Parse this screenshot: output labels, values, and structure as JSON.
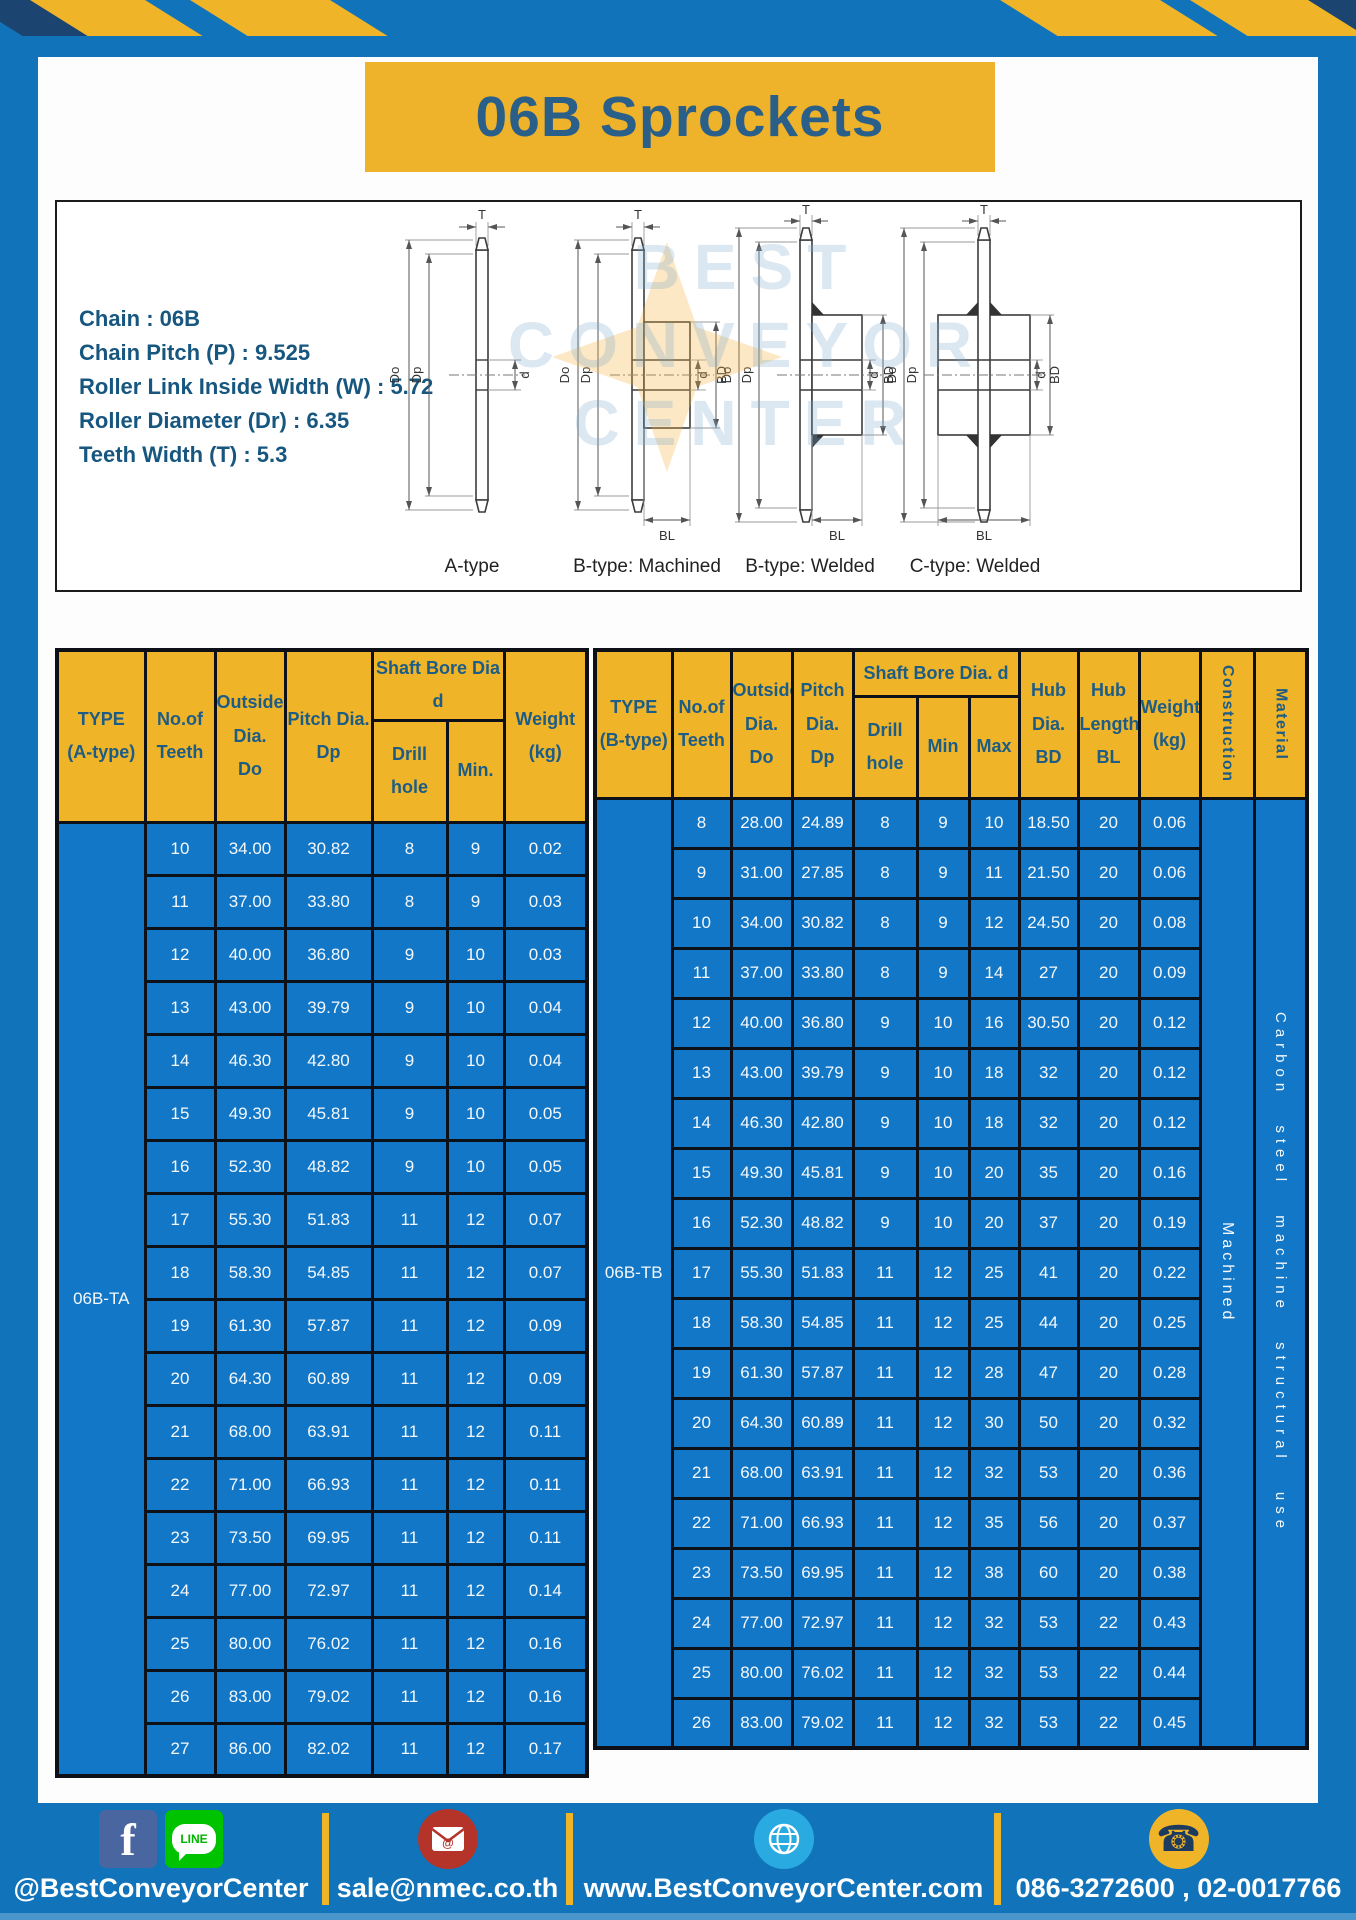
{
  "title": "06B Sprockets",
  "specs": {
    "lines": [
      "Chain : 06B",
      "Chain Pitch (P) : 9.525",
      "Roller Link Inside Width (W) : 5.72",
      "Roller Diameter (Dr) : 6.35",
      "Teeth Width (T) : 5.3"
    ]
  },
  "drawings": {
    "labels": {
      "T": "T",
      "Do": "Do",
      "Dp": "Dp",
      "d": "d",
      "BD": "BD",
      "BL": "BL"
    },
    "captions": [
      "A-type",
      "B-type: Machined",
      "B-type: Welded",
      "C-type: Welded"
    ]
  },
  "watermark": {
    "line1": "BEST",
    "line2": "CONVEYOR",
    "line3": "CENTER"
  },
  "table_a": {
    "headers": {
      "type": "TYPE\n(A-type)",
      "teeth": "No.of\nTeeth",
      "outside": "Outside\nDia.\nDo",
      "pitch": "Pitch Dia.\nDp",
      "shaft_group": "Shaft Bore Dia d",
      "drill": "Drill hole",
      "min": "Min.",
      "weight": "Weight\n(kg)"
    },
    "type_value": "06B-TA",
    "rows": [
      [
        "10",
        "34.00",
        "30.82",
        "8",
        "9",
        "0.02"
      ],
      [
        "11",
        "37.00",
        "33.80",
        "8",
        "9",
        "0.03"
      ],
      [
        "12",
        "40.00",
        "36.80",
        "9",
        "10",
        "0.03"
      ],
      [
        "13",
        "43.00",
        "39.79",
        "9",
        "10",
        "0.04"
      ],
      [
        "14",
        "46.30",
        "42.80",
        "9",
        "10",
        "0.04"
      ],
      [
        "15",
        "49.30",
        "45.81",
        "9",
        "10",
        "0.05"
      ],
      [
        "16",
        "52.30",
        "48.82",
        "9",
        "10",
        "0.05"
      ],
      [
        "17",
        "55.30",
        "51.83",
        "11",
        "12",
        "0.07"
      ],
      [
        "18",
        "58.30",
        "54.85",
        "11",
        "12",
        "0.07"
      ],
      [
        "19",
        "61.30",
        "57.87",
        "11",
        "12",
        "0.09"
      ],
      [
        "20",
        "64.30",
        "60.89",
        "11",
        "12",
        "0.09"
      ],
      [
        "21",
        "68.00",
        "63.91",
        "11",
        "12",
        "0.11"
      ],
      [
        "22",
        "71.00",
        "66.93",
        "11",
        "12",
        "0.11"
      ],
      [
        "23",
        "73.50",
        "69.95",
        "11",
        "12",
        "0.11"
      ],
      [
        "24",
        "77.00",
        "72.97",
        "11",
        "12",
        "0.14"
      ],
      [
        "25",
        "80.00",
        "76.02",
        "11",
        "12",
        "0.16"
      ],
      [
        "26",
        "83.00",
        "79.02",
        "11",
        "12",
        "0.16"
      ],
      [
        "27",
        "86.00",
        "82.02",
        "11",
        "12",
        "0.17"
      ]
    ]
  },
  "table_b": {
    "headers": {
      "type": "TYPE\n(B-type)",
      "teeth": "No.of\nTeeth",
      "outside": "Outside\nDia.\nDo",
      "pitch": "Pitch\nDia.\nDp",
      "shaft_group": "Shaft Bore Dia. d",
      "drill": "Drill hole",
      "min": "Min",
      "max": "Max",
      "hub_dia": "Hub\nDia.\nBD",
      "hub_len": "Hub\nLength\nBL",
      "weight": "Weight\n(kg)",
      "construction": "Construction",
      "material": "Material"
    },
    "type_value": "06B-TB",
    "construction_value": "Machined",
    "material_value": "Carbon steel machine structural use",
    "rows": [
      [
        "8",
        "28.00",
        "24.89",
        "8",
        "9",
        "10",
        "18.50",
        "20",
        "0.06"
      ],
      [
        "9",
        "31.00",
        "27.85",
        "8",
        "9",
        "11",
        "21.50",
        "20",
        "0.06"
      ],
      [
        "10",
        "34.00",
        "30.82",
        "8",
        "9",
        "12",
        "24.50",
        "20",
        "0.08"
      ],
      [
        "11",
        "37.00",
        "33.80",
        "8",
        "9",
        "14",
        "27",
        "20",
        "0.09"
      ],
      [
        "12",
        "40.00",
        "36.80",
        "9",
        "10",
        "16",
        "30.50",
        "20",
        "0.12"
      ],
      [
        "13",
        "43.00",
        "39.79",
        "9",
        "10",
        "18",
        "32",
        "20",
        "0.12"
      ],
      [
        "14",
        "46.30",
        "42.80",
        "9",
        "10",
        "18",
        "32",
        "20",
        "0.12"
      ],
      [
        "15",
        "49.30",
        "45.81",
        "9",
        "10",
        "20",
        "35",
        "20",
        "0.16"
      ],
      [
        "16",
        "52.30",
        "48.82",
        "9",
        "10",
        "20",
        "37",
        "20",
        "0.19"
      ],
      [
        "17",
        "55.30",
        "51.83",
        "11",
        "12",
        "25",
        "41",
        "20",
        "0.22"
      ],
      [
        "18",
        "58.30",
        "54.85",
        "11",
        "12",
        "25",
        "44",
        "20",
        "0.25"
      ],
      [
        "19",
        "61.30",
        "57.87",
        "11",
        "12",
        "28",
        "47",
        "20",
        "0.28"
      ],
      [
        "20",
        "64.30",
        "60.89",
        "11",
        "12",
        "30",
        "50",
        "20",
        "0.32"
      ],
      [
        "21",
        "68.00",
        "63.91",
        "11",
        "12",
        "32",
        "53",
        "20",
        "0.36"
      ],
      [
        "22",
        "71.00",
        "66.93",
        "11",
        "12",
        "35",
        "56",
        "20",
        "0.37"
      ],
      [
        "23",
        "73.50",
        "69.95",
        "11",
        "12",
        "38",
        "60",
        "20",
        "0.38"
      ],
      [
        "24",
        "77.00",
        "72.97",
        "11",
        "12",
        "32",
        "53",
        "22",
        "0.43"
      ],
      [
        "25",
        "80.00",
        "76.02",
        "11",
        "12",
        "32",
        "53",
        "22",
        "0.44"
      ],
      [
        "26",
        "83.00",
        "79.02",
        "11",
        "12",
        "32",
        "53",
        "22",
        "0.45"
      ]
    ]
  },
  "footer": {
    "facebook_line_label": "@BestConveyorCenter",
    "email_label": "sale@nmec.co.th",
    "web_label": "www.BestConveyorCenter.com",
    "phone_label": "086-3272600 , 02-0017766",
    "line_icon_text": "LINE",
    "facebook_icon_text": "f",
    "mail_icon_text": "@"
  },
  "colors": {
    "frame_blue": "#1173b9",
    "cell_blue": "#1377c8",
    "header_yellow": "#f0b429",
    "banner_yellow": "#eeb22b",
    "navy_text": "#1d5c85",
    "title_text": "#2a5f8a",
    "spec_text": "#17567f",
    "border_black": "#0d1117",
    "stripe_navy": "#1c4470",
    "facebook_blue": "#4a66a0",
    "line_green": "#00c300",
    "email_red": "#b5342a",
    "globe_blue": "#29abe2",
    "phone_yellow": "#f0b429"
  }
}
